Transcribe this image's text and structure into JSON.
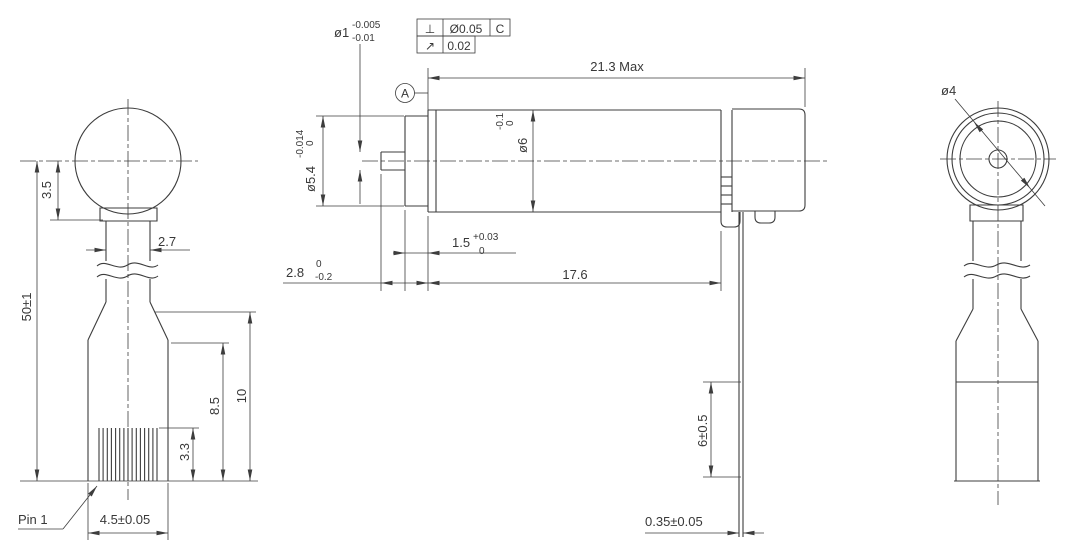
{
  "colors": {
    "line": "#3d3d3d",
    "background": "#ffffff"
  },
  "left_view": {
    "dim_ball_center_height": "3.5",
    "dim_neck_width": "2.7",
    "dim_overall_length": "50±1",
    "dim_pin_exposed": "8.5",
    "dim_tail_height": "10",
    "dim_pin_length": "3.3",
    "pin_label": "Pin 1",
    "dim_connector_width": "4.5±0.05"
  },
  "middle_view": {
    "shaft_dia_main": "ø1",
    "shaft_dia_upper": "-0.005",
    "shaft_dia_lower": "-0.01",
    "fcf_perp_symbol": "⊥",
    "fcf_perp_tol": "Ø0.05",
    "fcf_perp_datum": "C",
    "fcf_runout_symbol": "↗",
    "fcf_runout_tol": "0.02",
    "datum_label": "A",
    "dim_overall_length": "21.3 Max",
    "bushing_dia_main": "ø5.4",
    "bushing_dia_upper": "0",
    "bushing_dia_lower": "-0.014",
    "body_dia_main": "ø6",
    "body_dia_upper": "0",
    "body_dia_lower": "-0.1",
    "dim_bushing_length_main": "1.5",
    "dim_bushing_length_upper": "+0.03",
    "dim_bushing_length_lower": "0",
    "dim_shaft_protrusion_main": "2.8",
    "dim_shaft_protrusion_upper": "0",
    "dim_shaft_protrusion_lower": "-0.2",
    "dim_body_length": "17.6",
    "dim_lead_length": "6±0.5",
    "dim_lead_thickness": "0.35±0.05"
  },
  "right_view": {
    "dim_face_dia": "ø4"
  }
}
